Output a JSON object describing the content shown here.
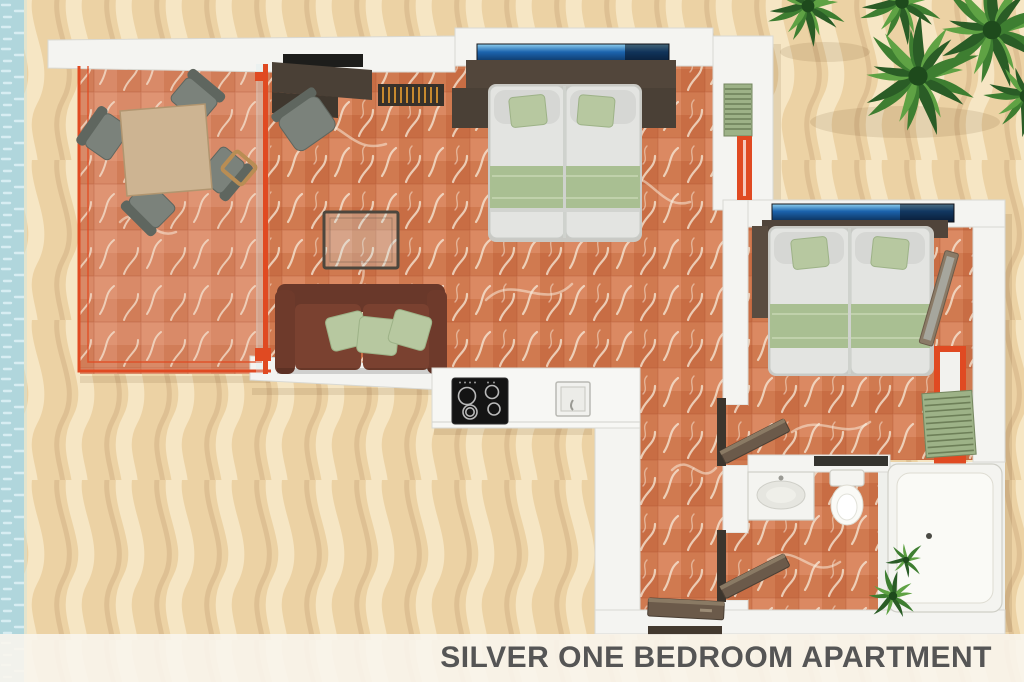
{
  "caption": {
    "title": "SILVER ONE BEDROOM APARTMENT"
  },
  "scene": {
    "description": "3D top-down floor plan render of an apartment placed on beach sand with sea edge and palm shrubs",
    "rooms": [
      "balcony-terrace",
      "living-area",
      "twin-bed-sleeping-area",
      "kitchenette",
      "hallway",
      "second-twin-bed-room",
      "bathroom"
    ]
  },
  "palette": {
    "sand_base": "#ecd2a4",
    "sand_light": "#f6e6c6",
    "sand_shadow": "#d9b88c",
    "water": "#b0d6dc",
    "water_light": "#dcf0f4",
    "wall": "#f4f4f1",
    "wall_edge": "#d9d9d3",
    "floor_base": "#d07a50",
    "floor_warm": "#e39570",
    "floor_deep": "#c05f38",
    "balcony_base": "#d98a68",
    "tile_line": "#a84a2c",
    "vein": "#f7ead9",
    "accent_red": "#e04a22",
    "wood_dark": "#4a4036",
    "wood_door": "#6b5a4a",
    "tv_black": "#1d1d1b",
    "sofa_brown": "#6e3a2b",
    "pillow_green": "#b7c8a0",
    "pillow_green_dark": "#9db287",
    "linen": "#e3e4e1",
    "linen_shadow": "#c9ccc8",
    "runner_green": "#a9bf92",
    "window_blue": "#1c64ae",
    "window_blue_dark": "#0b2d55",
    "chair_gray": "#7b827b",
    "chair_gray_dark": "#5f665f",
    "table_tan": "#cdb492",
    "stripe_gold": "#c8892e",
    "palm_dark": "#2a5c26",
    "palm_mid": "#3e7e31",
    "palm_light": "#5fa244",
    "caption_bg": "#f9f5ed",
    "caption_text": "#555555"
  }
}
